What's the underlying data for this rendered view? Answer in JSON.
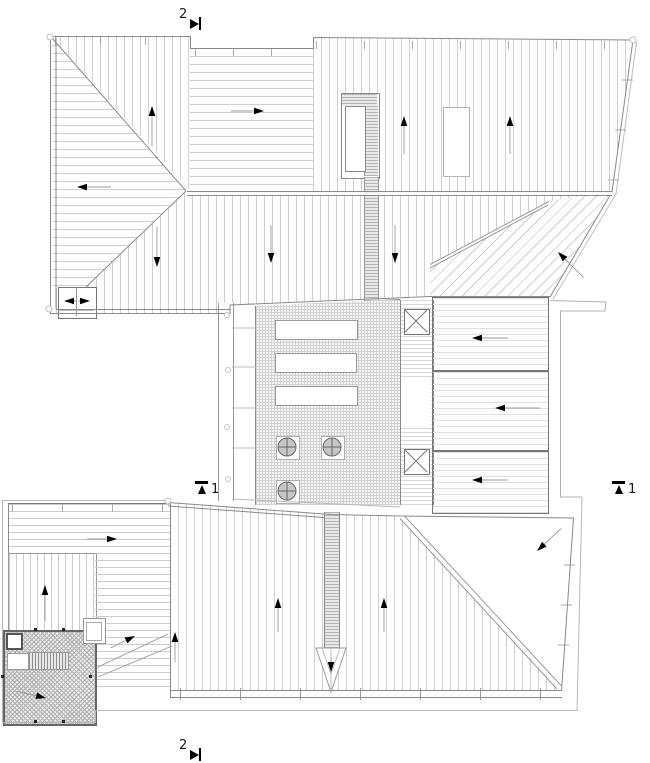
{
  "drawing": {
    "type": "architectural roof plan"
  },
  "section_markers": {
    "top": {
      "label": "2",
      "direction": "right"
    },
    "bottom": {
      "label": "2",
      "direction": "right"
    },
    "left": {
      "label": "1",
      "direction": "up"
    },
    "right": {
      "label": "1",
      "direction": "up"
    }
  },
  "colors": {
    "background": "#ffffff",
    "outline": "#8a8a8a",
    "outer_line": "#b8b8b8",
    "hatch": "#cfcfcf",
    "arrow_head": "#000000",
    "arrow_shaft": "#9a9a9a",
    "drain_fill": "#c6c6c6"
  },
  "roof_sections": [
    {
      "id": "upper-left-top-wedge",
      "hatch": "vertical"
    },
    {
      "id": "upper-left-side-wedge",
      "hatch": "horizontal"
    },
    {
      "id": "upper-middle-strip",
      "hatch": "horizontal"
    },
    {
      "id": "upper-right-field",
      "hatch": "vertical"
    },
    {
      "id": "upper-lower-field",
      "hatch": "vertical"
    },
    {
      "id": "upper-right-triangle",
      "hatch": "diagonal"
    },
    {
      "id": "terrace",
      "hatch": "grid"
    },
    {
      "id": "right-panel-1",
      "hatch": "horizontal"
    },
    {
      "id": "right-panel-2",
      "hatch": "horizontal"
    },
    {
      "id": "right-panel-3",
      "hatch": "horizontal"
    },
    {
      "id": "lower-left-band",
      "hatch": "horizontal"
    },
    {
      "id": "lower-left-panel",
      "hatch": "vertical"
    },
    {
      "id": "lower-left-crosshatch",
      "hatch": "crosshatch"
    },
    {
      "id": "lower-main-field",
      "hatch": "vertical"
    },
    {
      "id": "lower-right-triangle",
      "hatch": "diagonal"
    }
  ],
  "slope_arrows": [
    {
      "x": 152,
      "y": 106,
      "angle": -90,
      "len": 40
    },
    {
      "x": 264,
      "y": 111,
      "angle": 0,
      "len": 33
    },
    {
      "x": 404,
      "y": 116,
      "angle": -90,
      "len": 38
    },
    {
      "x": 510,
      "y": 116,
      "angle": -90,
      "len": 38
    },
    {
      "x": 77,
      "y": 187,
      "angle": 180,
      "len": 34
    },
    {
      "x": 157,
      "y": 267,
      "angle": 90,
      "len": 40
    },
    {
      "x": 271,
      "y": 263,
      "angle": 90,
      "len": 38
    },
    {
      "x": 395,
      "y": 263,
      "angle": 90,
      "len": 38
    },
    {
      "x": 558,
      "y": 252,
      "angle": -135,
      "len": 36
    },
    {
      "x": 64,
      "y": 301,
      "angle": 180,
      "len": 12
    },
    {
      "x": 90,
      "y": 301,
      "angle": 0,
      "len": 12
    },
    {
      "x": 472,
      "y": 338,
      "angle": 180,
      "len": 36
    },
    {
      "x": 495,
      "y": 408,
      "angle": 180,
      "len": 45
    },
    {
      "x": 472,
      "y": 480,
      "angle": 180,
      "len": 36
    },
    {
      "x": 117,
      "y": 539,
      "angle": 0,
      "len": 30
    },
    {
      "x": 45,
      "y": 585,
      "angle": -90,
      "len": 36
    },
    {
      "x": 135,
      "y": 636,
      "angle": -26,
      "len": 27
    },
    {
      "x": 175,
      "y": 632,
      "angle": -90,
      "len": 30
    },
    {
      "x": 278,
      "y": 598,
      "angle": -90,
      "len": 34
    },
    {
      "x": 384,
      "y": 598,
      "angle": -90,
      "len": 34
    },
    {
      "x": 537,
      "y": 551,
      "angle": 137,
      "len": 33
    },
    {
      "x": 46,
      "y": 698,
      "angle": 13,
      "len": 30
    },
    {
      "x": 331,
      "y": 672,
      "angle": 90,
      "len": 14
    }
  ],
  "drains": [
    {
      "cx": 287,
      "cy": 447
    },
    {
      "cx": 332,
      "cy": 447
    },
    {
      "cx": 287,
      "cy": 491
    }
  ],
  "corner_circles": [
    {
      "cx": 50,
      "cy": 37
    },
    {
      "cx": 633,
      "cy": 40
    },
    {
      "cx": 49,
      "cy": 309
    },
    {
      "cx": 168,
      "cy": 501
    }
  ],
  "edge_circles": [
    {
      "cx": 227,
      "cy": 315
    },
    {
      "cx": 228,
      "cy": 370
    },
    {
      "cx": 227,
      "cy": 427
    },
    {
      "cx": 228,
      "cy": 479
    }
  ]
}
